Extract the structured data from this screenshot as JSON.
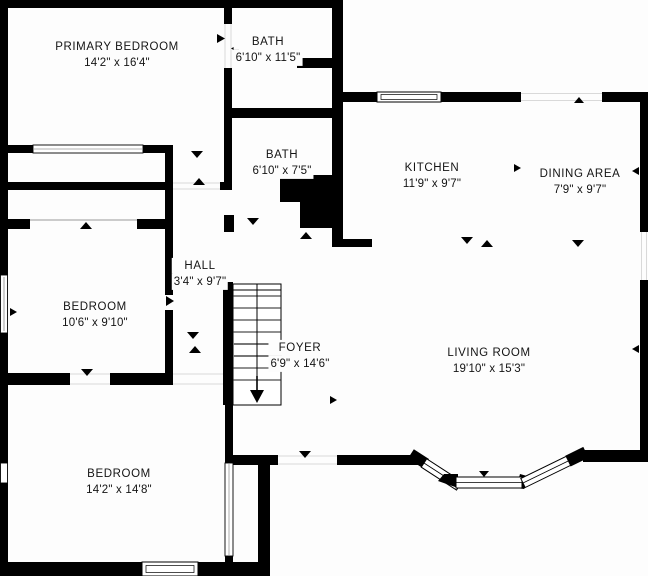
{
  "colors": {
    "wall": "#000000",
    "background": "#fdfdfd",
    "text": "#141414"
  },
  "rooms": [
    {
      "id": "primary-bedroom",
      "name": "PRIMARY BEDROOM",
      "dims": "14'2\" x 16'4\""
    },
    {
      "id": "bath-top",
      "name": "BATH",
      "dims": "6'10\" x 11'5\""
    },
    {
      "id": "bath-middle",
      "name": "BATH",
      "dims": "6'10\" x 7'5\""
    },
    {
      "id": "kitchen",
      "name": "KITCHEN",
      "dims": "11'9\" x 9'7\""
    },
    {
      "id": "dining-area",
      "name": "DINING AREA",
      "dims": "7'9\" x 9'7\""
    },
    {
      "id": "hall",
      "name": "HALL",
      "dims": "3'4\" x 9'7\""
    },
    {
      "id": "bedroom-middle",
      "name": "BEDROOM",
      "dims": "10'6\" x 9'10\""
    },
    {
      "id": "foyer",
      "name": "FOYER",
      "dims": "6'9\" x 14'6\""
    },
    {
      "id": "living-room",
      "name": "LIVING ROOM",
      "dims": "19'10\" x 15'3\""
    },
    {
      "id": "bedroom-bottom",
      "name": "BEDROOM",
      "dims": "14'2\" x 14'8\""
    }
  ]
}
